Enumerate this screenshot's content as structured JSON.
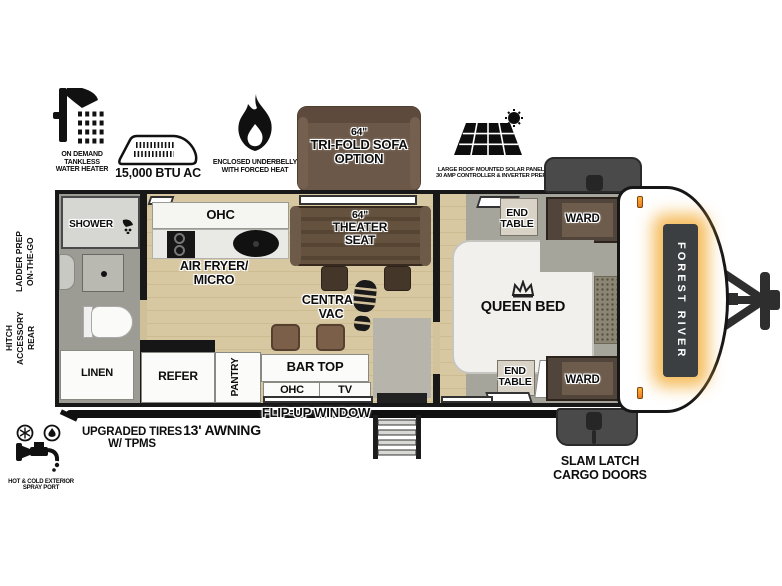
{
  "brand": "FOREST RIVER",
  "top_features": {
    "water_heater": {
      "lines": [
        "ON DEMAND",
        "TANKLESS",
        "WATER HEATER"
      ]
    },
    "ac": {
      "label": "15,000 BTU AC"
    },
    "underbelly": {
      "lines": [
        "ENCLOSED UNDERBELLY",
        "WITH FORCED HEAT"
      ]
    },
    "sofa_option": {
      "lines": [
        "64\"",
        "TRI-FOLD SOFA",
        "OPTION"
      ]
    },
    "solar": {
      "lines": [
        "LARGE ROOF MOUNTED SOLAR PANEL",
        "30 AMP CONTROLLER & INVERTER PREP"
      ]
    }
  },
  "left_features": {
    "ladder_prep": {
      "lines": [
        "ON-THE-GO",
        "LADDER PREP"
      ]
    },
    "rear_hitch": {
      "lines": [
        "REAR",
        "ACCESSORY",
        "HITCH"
      ]
    }
  },
  "bottom_features": {
    "spray_port": {
      "lines": [
        "HOT & COLD EXTERIOR",
        "SPRAY PORT"
      ]
    },
    "tires": {
      "lines": [
        "UPGRADED TIRES",
        "W/ TPMS"
      ]
    },
    "awning": {
      "label": "13' AWNING"
    },
    "flip_window": {
      "label": "FLIP-UP WINDOW"
    },
    "cargo_doors": {
      "lines": [
        "SLAM LATCH",
        "CARGO DOORS"
      ]
    }
  },
  "rooms": {
    "bathroom": {
      "shower": "SHOWER",
      "linen": "LINEN"
    },
    "kitchen": {
      "ohc": "OHC",
      "air_fryer_lines": [
        "AIR FRYER/",
        "MICRO"
      ],
      "refer": "REFER",
      "pantry": "PANTRY",
      "bar_top": "BAR TOP",
      "bar_ohc": "OHC",
      "tv": "TV"
    },
    "living": {
      "theater_seat_lines": [
        "64\"",
        "THEATER",
        "SEAT"
      ],
      "central_vac_lines": [
        "CENTRAL",
        "VAC"
      ]
    },
    "bedroom": {
      "bed": "QUEEN BED",
      "end_table_top_lines": [
        "END",
        "TABLE"
      ],
      "end_table_bottom_lines": [
        "END",
        "TABLE"
      ],
      "ward_top": "WARD",
      "ward_bottom": "WARD"
    }
  },
  "colors": {
    "wood_floor": "#d3c29c",
    "tile_floor": "#a5a49b",
    "accent_amber": "#f2a93b",
    "cabinet_brown": "#51443a",
    "sofa_brown": "#6b5848",
    "theater_brown": "#5d4b3c",
    "cargo_gray": "#4a4a4a",
    "line_black": "#181818"
  }
}
